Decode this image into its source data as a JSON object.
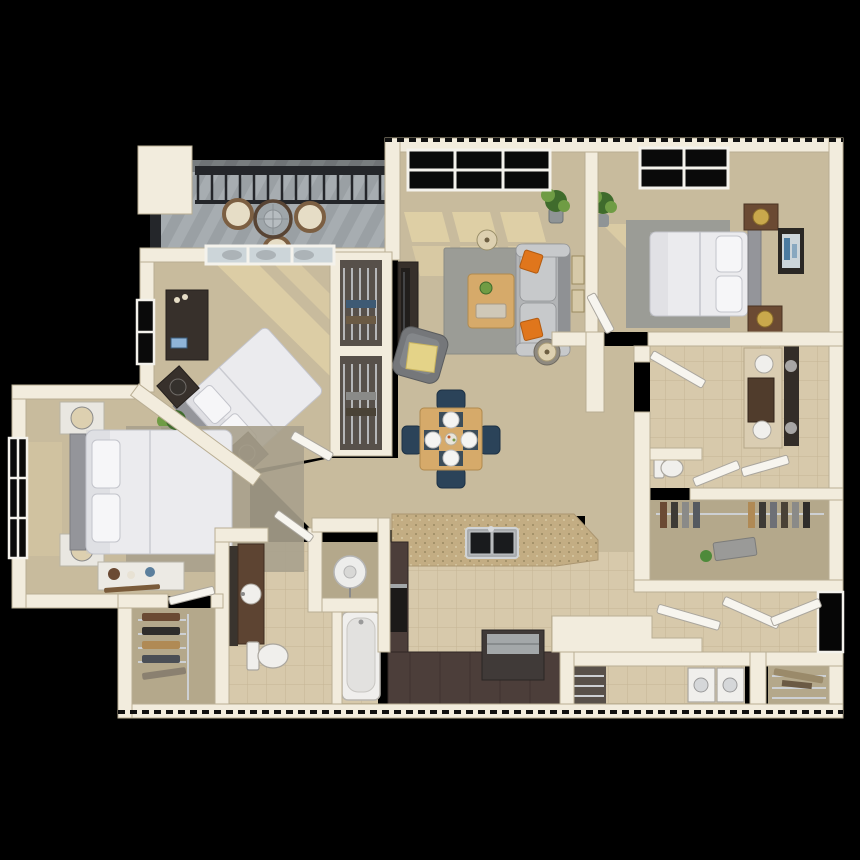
{
  "scene": {
    "title": "3D rendered apartment floor plan, top-down bird's-eye view",
    "style": "photoreal 3D dollhouse render on black background",
    "visible_text": "none"
  },
  "palette": {
    "bg": "#000000",
    "wall": "#f2ecdd",
    "wallShade": "#ddd3bc",
    "wallEdge": "#b9ae94",
    "carpet": "#c8bb9d",
    "carpetDark": "#b4a88b",
    "sun": "#ecdcab",
    "tile": "#d7c9ab",
    "tileLine": "#c0b08e",
    "deck": "#9aa0a4",
    "deckStripe": "#b2b8bc",
    "railing": "#24262a",
    "glass": "#ccd5d9",
    "glassFrame": "#f4f2ec",
    "rugGray": "#9b9c96",
    "rugTan": "#a9a18d",
    "sofa": "#b2b4b6",
    "sofaDark": "#8f9194",
    "sofaLight": "#c7c9cb",
    "orange": "#e0761c",
    "wood": "#d6aa6a",
    "woodEdge": "#b08a4e",
    "navy": "#2b4359",
    "navyDark": "#1e3245",
    "darkFurniture": "#37302b",
    "tv": "#211e1c",
    "bedWhite": "#ebebee",
    "bedShadow": "#c3c4cb",
    "headboard": "#94959a",
    "nightstand": "#e9e7e1",
    "brownWood": "#6b4a33",
    "gold": "#c9a84c",
    "cabinet": "#4c3e3a",
    "cabinetEdge": "#2f2624",
    "counter": "#c3ad83",
    "steel": "#a3a7a9",
    "appliance": "#1c1a19",
    "fixtureWhite": "#f0efec",
    "fixtureStroke": "#aaa69e",
    "doorLeaf": "#f7f5ef",
    "plantDark": "#3f6b2c",
    "plantLight": "#6f9c44",
    "pot": "#8f9496",
    "wicker": "#7c5f42",
    "cushion": "#e6ddc6",
    "closetInterior": "#57504a",
    "wire": "#cdd0d3",
    "artBlue": "#4a7aa0",
    "lampShade": "#ddd0b0",
    "yellowThrow": "#e4d388"
  },
  "rooms": [
    {
      "id": "balcony",
      "label": "Balcony",
      "floor": "gray deck"
    },
    {
      "id": "living-room",
      "label": "Living Room",
      "floor": "tan carpet"
    },
    {
      "id": "dining-area",
      "label": "Dining Area",
      "floor": "tan carpet"
    },
    {
      "id": "kitchen",
      "label": "Kitchen",
      "floor": "beige tile"
    },
    {
      "id": "entry",
      "label": "Entry Hall",
      "floor": "beige tile"
    },
    {
      "id": "bedroom-2",
      "label": "Bedroom 2 (angled bed)",
      "floor": "tan carpet"
    },
    {
      "id": "bedroom-3",
      "label": "Bedroom 3",
      "floor": "tan carpet"
    },
    {
      "id": "master-bedroom",
      "label": "Master Bedroom",
      "floor": "tan carpet"
    },
    {
      "id": "master-bathroom",
      "label": "Master Bathroom",
      "floor": "beige tile"
    },
    {
      "id": "master-closet",
      "label": "Master Walk-in Closet",
      "floor": "tan carpet"
    },
    {
      "id": "bathroom-2",
      "label": "Bathroom 2 (double vanity)",
      "floor": "beige tile"
    },
    {
      "id": "walk-in-closet-2",
      "label": "Walk-in Closet 2",
      "floor": "tan carpet"
    },
    {
      "id": "laundry-room",
      "label": "Laundry / Utility",
      "floor": "beige tile"
    },
    {
      "id": "pantry",
      "label": "Storage / Pantry",
      "floor": "carpet with wire shelves"
    },
    {
      "id": "hallway",
      "label": "Hallway",
      "floor": "tan carpet"
    }
  ],
  "furniture": {
    "balcony": [
      "round-glass-patio-table",
      "wicker-chair",
      "wicker-chair",
      "wicker-chair",
      "dark-metal-railing"
    ],
    "living_room": [
      "tv-console",
      "flat-tv",
      "gray-rug",
      "wood-coffee-table",
      "gray-sofa",
      "orange-pillow",
      "orange-pillow",
      "armchair-with-throw",
      "side-table-lamp",
      "floor-lamp",
      "potted-plant",
      "wall-frames"
    ],
    "dining_area": [
      "square-wood-table",
      "navy-chair-x4",
      "place-setting-x4",
      "centerpiece"
    ],
    "kitchen": [
      "granite-peninsula-counter",
      "double-sink",
      "dark-cabinet-run",
      "black-range",
      "steel-top-appliance",
      "white-bar-counter"
    ],
    "bedroom_2": [
      "sliding-glass-door",
      "dark-dresser",
      "diagonal-queen-bed",
      "bedside-lamp-x2",
      "potted-plant",
      "reach-in-closet-x2",
      "window"
    ],
    "bedroom_3": [
      "queen-bed",
      "brown-nightstand-x2",
      "gold-lamp-x2",
      "gray-rug",
      "wall-art",
      "potted-plant",
      "window"
    ],
    "master_bedroom": [
      "queen-bed",
      "white-nightstand-x2",
      "beige-lamp-x2",
      "storage-bench",
      "gray-rug",
      "potted-plant",
      "window"
    ],
    "master_bathroom": [
      "vanity-with-sink",
      "mirror",
      "toilet",
      "bathtub",
      "water-heater"
    ],
    "bathroom_2": [
      "double-vanity",
      "mirror",
      "sink-x2",
      "toilet",
      "bifold-doors"
    ],
    "closets": [
      "wire-shelving",
      "hanging-clothes",
      "shoe-shelves"
    ],
    "laundry": [
      "washer",
      "dryer",
      "wire-cubby"
    ],
    "entry": [
      "front-door-open",
      "open-door-leaves"
    ]
  },
  "counts": {
    "balcony_chairs": 3,
    "dining_seats": 4,
    "bathroom2_sinks": 2,
    "bedrooms": 3,
    "bathrooms": 2
  }
}
